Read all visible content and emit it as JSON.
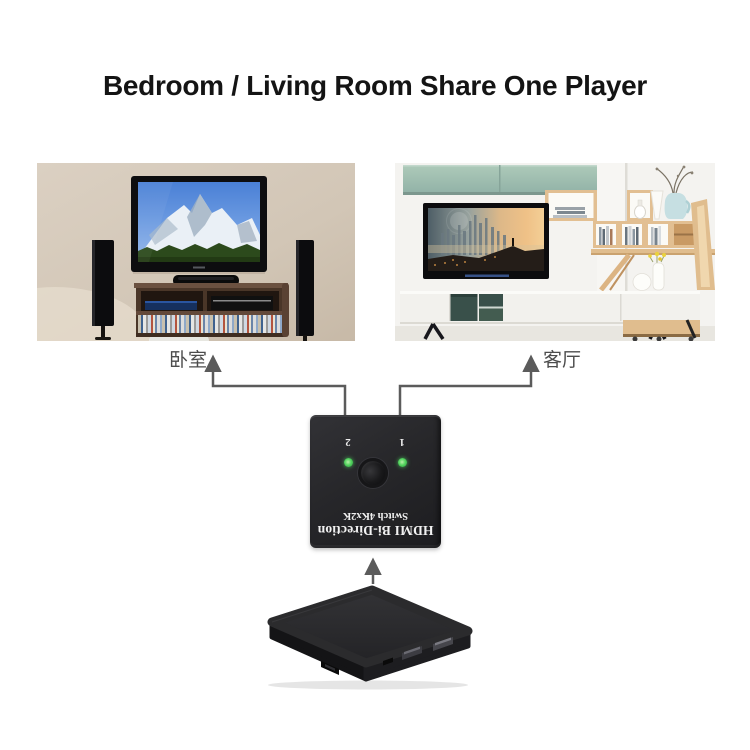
{
  "title": "Bedroom / Living Room Share One Player",
  "rooms": {
    "bedroom": {
      "label": "卧室"
    },
    "living_room": {
      "label": "客厅"
    }
  },
  "switch_device": {
    "brand_line1": "HDMI Bi-Direction",
    "brand_line2": "Switch 4Kx2K",
    "port1_label": "1",
    "port2_label": "2",
    "led_color": "#3ec653",
    "body_color": "#242427"
  },
  "player_device": {
    "type": "media player set-top box",
    "body_color": "#232325"
  },
  "connectors": {
    "color": "#5b5b5b",
    "count": 3
  },
  "canvas": {
    "background": "#ffffff"
  }
}
